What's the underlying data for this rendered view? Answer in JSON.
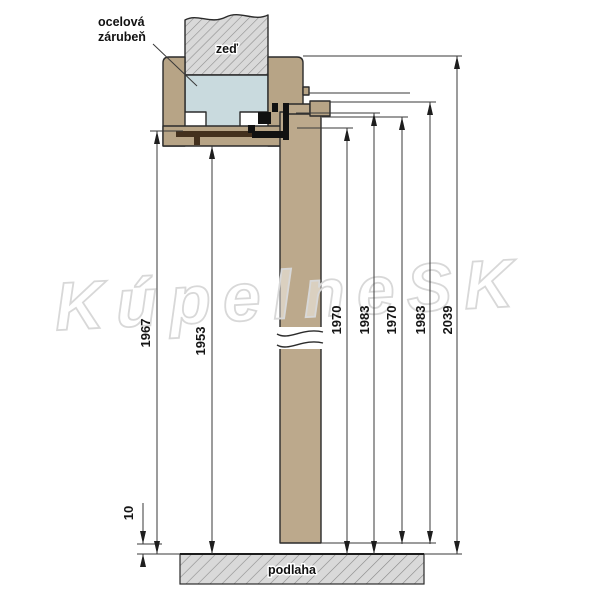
{
  "watermark": {
    "text": "KúpelneSK"
  },
  "callout": {
    "line1": "ocelová",
    "line2": "zárubeň"
  },
  "labels": {
    "wall": "zeď",
    "floor": "podlaha"
  },
  "dimensions_mm": [
    "1967",
    "1953",
    "1970",
    "1983",
    "1970",
    "1983",
    "2039",
    "10"
  ],
  "colors": {
    "frame_wood": "#b7a486",
    "leaf_wood": "#bca98c",
    "steel_fill": "#c9dade",
    "hatch_bg": "#d9d9d9",
    "hatch_line": "#8f8f8f",
    "detail_dark": "#43301d",
    "line": "#3a3a3a"
  }
}
